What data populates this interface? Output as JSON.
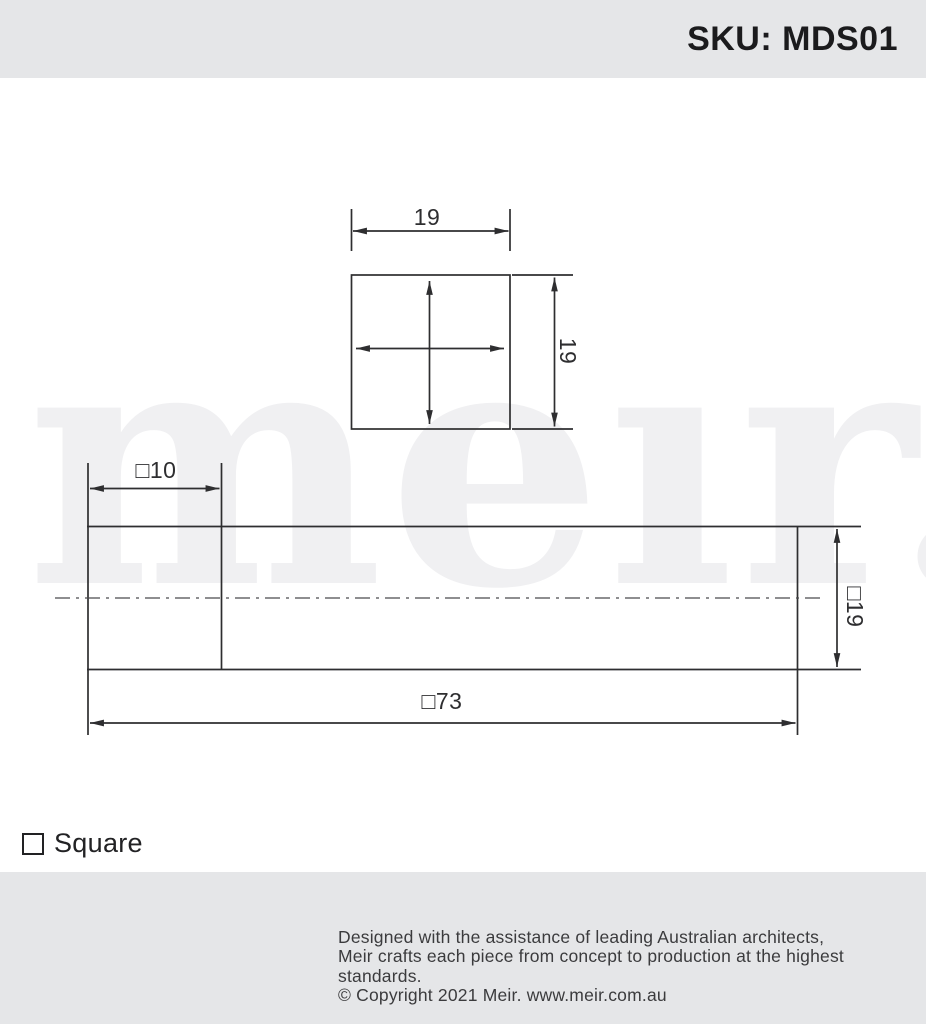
{
  "header": {
    "sku": "SKU: MDS01",
    "bg_color": "#e5e6e8",
    "text_color": "#1b1b1d"
  },
  "watermark": {
    "text": "meır.",
    "color": "#f0f0f2"
  },
  "drawing": {
    "line_color": "#2e2e30",
    "front_view": {
      "width_dim": "19",
      "height_dim": "19"
    },
    "side_view": {
      "socket_dim": "□10",
      "height_dim": "□19",
      "length_dim": "□73"
    }
  },
  "legend": {
    "label": "Square"
  },
  "footer": {
    "logo_text": "meır.",
    "registered_mark": "®",
    "line1": "Designed with the assistance of leading Australian architects,",
    "line2": "Meir crafts each piece from concept to production at the highest standards.",
    "line3": "© Copyright 2021 Meir. www.meir.com.au",
    "bg_color": "#e5e6e8",
    "text_color": "#3b3b3d"
  }
}
